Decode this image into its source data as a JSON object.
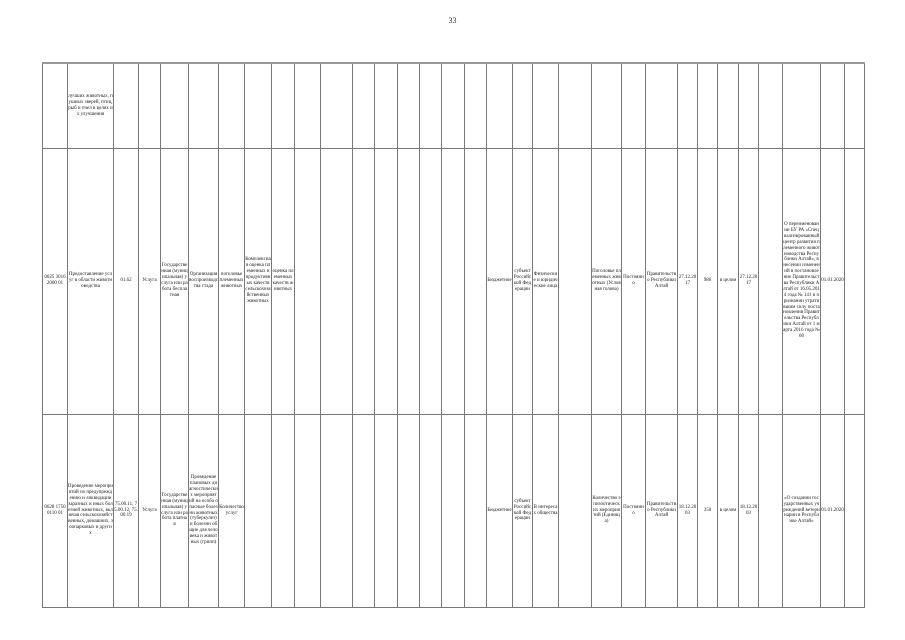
{
  "page": {
    "number": "33"
  },
  "table": {
    "rows": [
      {
        "cells": [
          "",
          "лучших животных, пушных зверей, птиц, рыб и пчел в целях их улучшения",
          "",
          "",
          "",
          "",
          "",
          "",
          "",
          "",
          "",
          "",
          "",
          "",
          "",
          "",
          "",
          "",
          "",
          "",
          "",
          "",
          "",
          "",
          "",
          "",
          "",
          "",
          "",
          "",
          "",
          ""
        ]
      },
      {
        "cells": [
          "0625 3016 2000 01",
          "Предоставление услуг в области животноводства",
          "01.62",
          "Услуга",
          "Государственная (муниципальная) услуга или работа бесплатная",
          "Организация воспроизводства стада",
          "поголовье племенных животных",
          "Комплексная оценка племенных и продуктивных качеств сельскохозяйственных животных",
          "оценка племенных качеств животных",
          "",
          "",
          "",
          "",
          "",
          "",
          "",
          "",
          "Бюджетное",
          "субъект Российской Федерации",
          "Физические и юридические лица",
          "",
          "Поголовье племенных животных (Условная голова)",
          "Постоянно",
          "Правительство Республики Алтай",
          "27.12.2017",
          "986",
          "в целом",
          "27.12.2017",
          "",
          "О переименовании БУ РА «Специализированный центр развития племенного животноводства Республики Алтай», внесении изменений в постановление Правительства Республики Алтай от 16.05.2014 года № 141 и признании утратившим силу постановления Правительства Республики Алтай от 1 марта 2016 года № 60",
          "01.01.2020",
          ""
        ]
      },
      {
        "cells": [
          "0628 1750 0110 01",
          "Проведение мероприятий по предупреждению и ликвидации заразных и иных болезней животных, включая сельскохозяйственных, домашних, зоопарковых и других",
          "75.00.11, 75.00.12, 75.00.19",
          "Услуга",
          "Государственная (муниципальная) услуга или работа платная",
          "Проведение плановых диагностических мероприятий на особо опасные болезни животных (туберкулез) и болезни общие для человека и животных (грипп)",
          "Количество услуг",
          "",
          "",
          "",
          "",
          "",
          "",
          "",
          "",
          "",
          "",
          "Бюджетное",
          "субъект Российской Федерации",
          "В интересах общества",
          "",
          "Количество эпизоотических мероприятий (Единица)",
          "Постоянно",
          "Правительство Республики Алтай",
          "18.12.2003",
          "350",
          "в целом",
          "18.12.2003",
          "",
          "«О создании государственных учреждений ветеринарии в Республике Алтай»",
          "01.01.2020",
          ""
        ]
      }
    ]
  }
}
